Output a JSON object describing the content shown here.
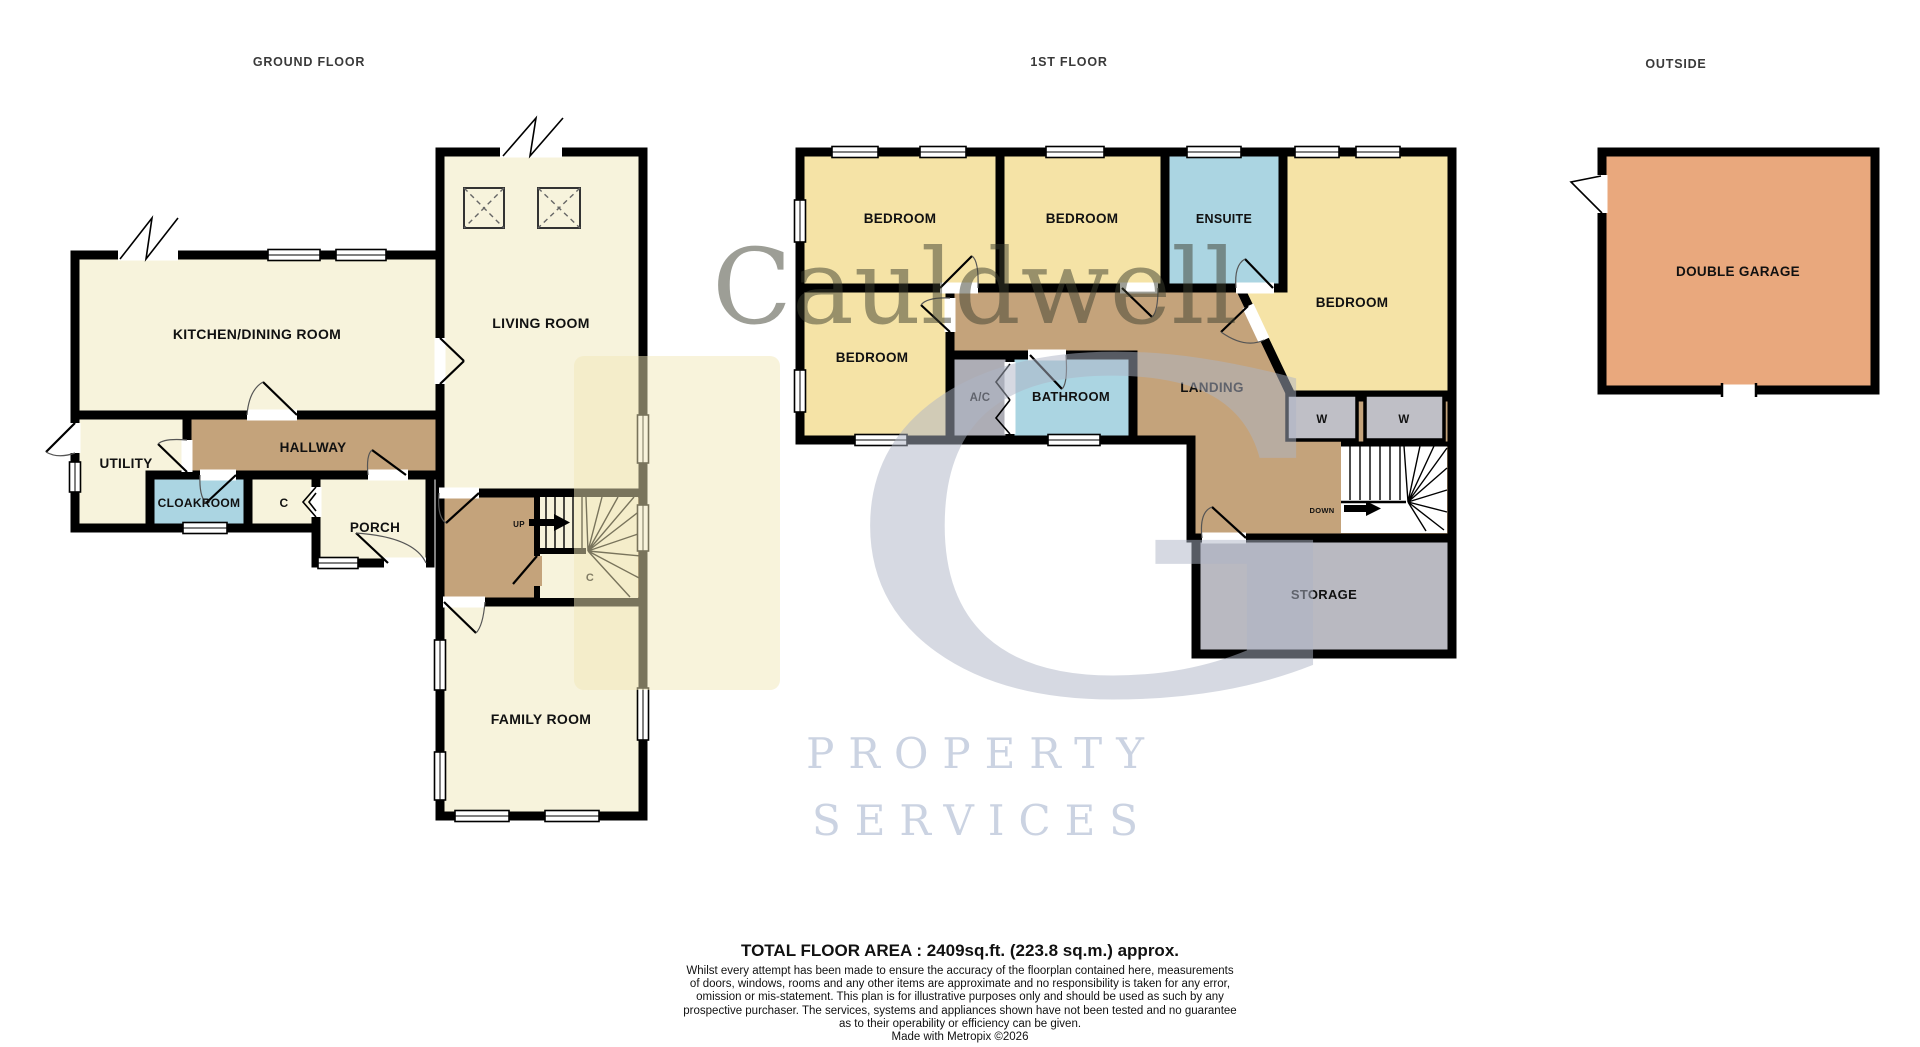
{
  "header": {
    "ground_floor": "GROUND FLOOR",
    "first_floor": "1ST FLOOR",
    "outside": "OUTSIDE"
  },
  "rooms": {
    "kitchen": "KITCHEN/DINING ROOM",
    "living": "LIVING ROOM",
    "utility": "UTILITY",
    "hallway": "HALLWAY",
    "cloakroom": "CLOAKROOM",
    "cupboard_c": "C",
    "porch": "PORCH",
    "stairs_up": "UP",
    "under_stairs_c": "C",
    "family": "FAMILY ROOM",
    "bedroom1": "BEDROOM",
    "bedroom2": "BEDROOM",
    "ensuite": "ENSUITE",
    "bedroom3": "BEDROOM",
    "bedroom4": "BEDROOM",
    "ac": "A/C",
    "bathroom": "BATHROOM",
    "landing": "LANDING",
    "wardrobe1": "W",
    "wardrobe2": "W",
    "stairs_down": "DOWN",
    "storage": "STORAGE",
    "garage": "DOUBLE GARAGE"
  },
  "watermark": {
    "brand": "Cauldwell",
    "monogram": "G",
    "line1": "PROPERTY",
    "line2": "SERVICES"
  },
  "footer": {
    "total_area": "TOTAL FLOOR AREA : 2409sq.ft. (223.8 sq.m.) approx.",
    "disclaimer_lines": [
      "Whilst every attempt has been made to ensure the accuracy of the floorplan contained here, measurements",
      "of doors, windows, rooms and any other items are approximate and no responsibility is taken for any error,",
      "omission or mis-statement. This plan is for illustrative purposes only and should be used as such by any",
      "prospective purchaser. The services, systems and appliances shown have not been tested and no guarantee",
      "as to their operability or efficiency can be given."
    ],
    "credit": "Made with Metropix ©2026"
  },
  "colors": {
    "room_cream": "#F7F3DC",
    "bedroom_yellow": "#F5E3A6",
    "hall_brown": "#C4A37B",
    "wet_room_blue": "#ABD5E2",
    "ac_gray": "#ADADB5",
    "wardrobe_gray": "#BFBFC6",
    "storage_gray": "#B9B9C1",
    "garage_orange": "#E9A87D",
    "wall": "#000000",
    "watermark_olive": "#3E4030",
    "watermark_blue": "#AEB5C6",
    "watermark_cream": "#F1E7B7",
    "watermark_lightblue": "#CBD3E2"
  }
}
